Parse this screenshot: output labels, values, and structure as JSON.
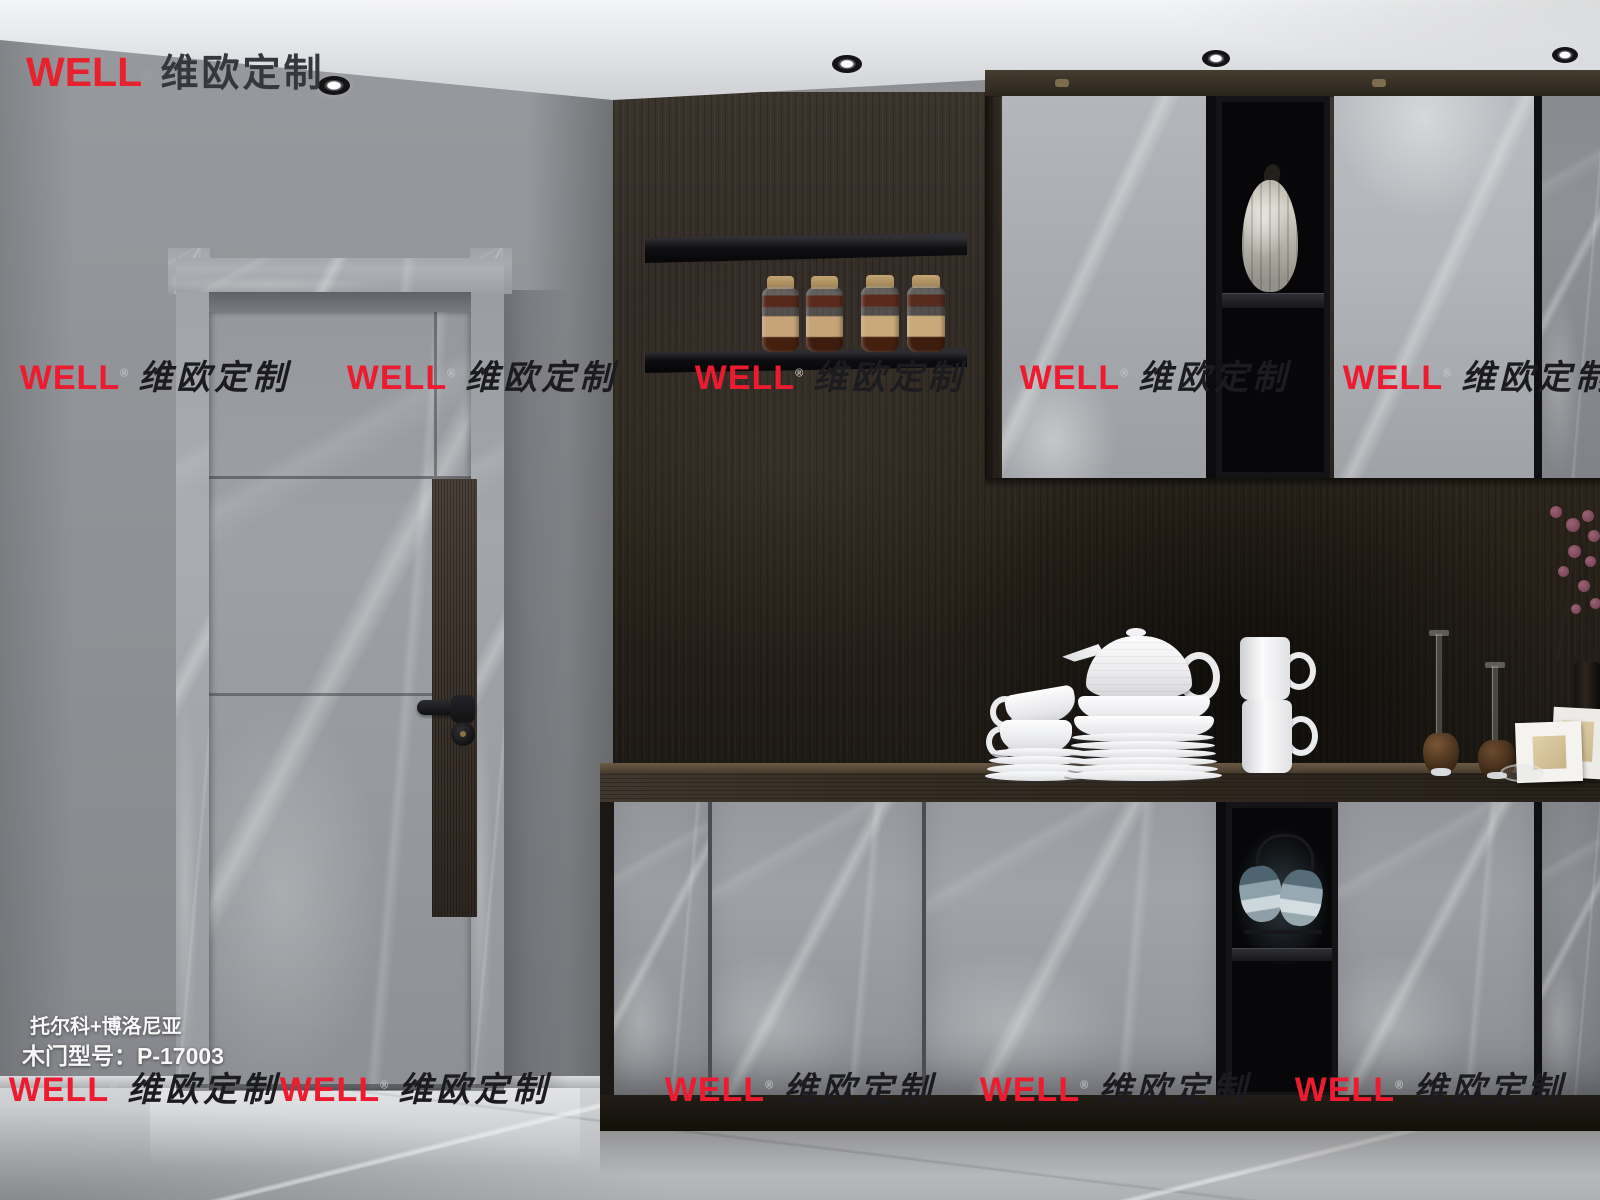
{
  "brand": {
    "logo_en": "WELL",
    "registered": "®",
    "logo_cn": "维欧定制",
    "tagline": "慕致生活 | 奢华品质"
  },
  "product": {
    "series": "托尔科+博洛尼亚",
    "model": "木门型号：P-17003"
  },
  "watermark": {
    "en": "WELL",
    "registered": "®",
    "cn": "维欧定制"
  },
  "palette": {
    "accent_red": "#ed1b2f",
    "watermark_text": "#1c1c20",
    "logo_cn_color": "#34373d",
    "wall_gray": "#8d8f94",
    "dark_wood": "#2e2823",
    "marble_light": "#aaadb2",
    "ceiling_white": "#eceded",
    "floor_gray": "#c6c8cb",
    "product_text": "#f7f7f8"
  },
  "scene": {
    "description": "Interior rendering: gray marble door (left), dark wood wall with floating shelves and jars, gray marble upper/lower cabinets with black display niches, white dishware on dark counter"
  }
}
